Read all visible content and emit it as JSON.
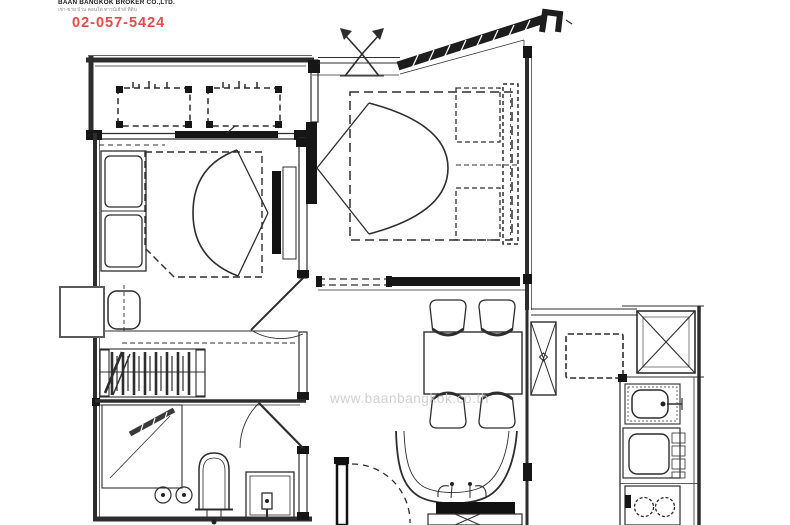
{
  "branding": {
    "company_name": "BAAN BANGKOK BROKER CO.,LTD.",
    "company_subtitle": "เช่า-ขาย บ้าน คอนโด ทาวน์เฮ้าส์ ที่ดิน",
    "phone": "02-057-5424"
  },
  "watermark": {
    "text": "www.baanbangkok.co.th"
  },
  "colors": {
    "line": "#2d2d2d",
    "wall": "#161616",
    "accent_red": "#e14b4b",
    "watermark_gray": "#c9c9c9",
    "background": "#ffffff"
  },
  "floorplan": {
    "type": "condo-unit-floor-plan",
    "areas": [
      {
        "name": "balcony",
        "furniture": [
          "ac-condenser-unit",
          "ac-condenser-unit"
        ]
      },
      {
        "name": "bedroom-2",
        "furniture": [
          "wardrobe",
          "double-bed",
          "tv-panel",
          "swing-door"
        ]
      },
      {
        "name": "master-bedroom",
        "furniture": [
          "double-bed",
          "pillows",
          "headboard",
          "sliding-door"
        ]
      },
      {
        "name": "walk-in-closet",
        "furniture": [
          "clothes-rail",
          "stool"
        ]
      },
      {
        "name": "bathroom",
        "furniture": [
          "shower",
          "toilet",
          "wash-basin",
          "swing-door"
        ]
      },
      {
        "name": "dining-area",
        "furniture": [
          "dining-table",
          "chair",
          "chair",
          "chair",
          "chair"
        ]
      },
      {
        "name": "living-area",
        "furniture": [
          "sofa",
          "tv-console",
          "entrance-door"
        ]
      },
      {
        "name": "kitchen",
        "furniture": [
          "service-shaft",
          "refrigerator",
          "sink",
          "counter",
          "stove"
        ]
      }
    ]
  }
}
